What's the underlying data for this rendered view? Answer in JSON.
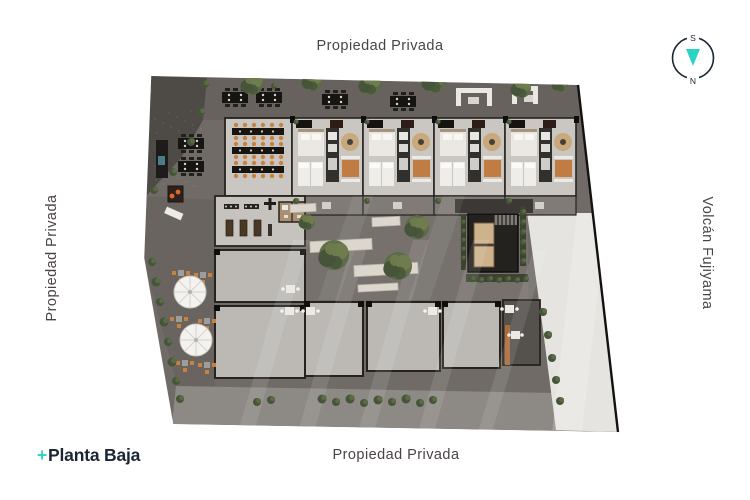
{
  "labels": {
    "top": "Propiedad Privada",
    "bottom": "Propiedad Privada",
    "left": "Propiedad Privada",
    "right": "Volcán Fujiyama"
  },
  "logo": {
    "prefix": "+",
    "text": "Planta Baja"
  },
  "compass": {
    "top_letter": "S",
    "bottom_letter": "N"
  },
  "colors": {
    "label": "#4b4444",
    "navy": "#1b2533",
    "teal": "#2bd4c2",
    "line_black": "#131210",
    "paving": "#706b67",
    "paving_dark": "#5e5a56",
    "gravel": "#4e4b47",
    "floor": "#cac7c3",
    "floor_dim": "#bcb9b5",
    "terrace": "#807b77",
    "wall": "#26231f",
    "black": "#161512",
    "cream": "#ebe8e3",
    "tan": "#c9a87c",
    "orange": "#c07c42",
    "rust": "#ad6a35",
    "chair": "#c8823f",
    "green": "#5d6b45",
    "green_dark": "#46553a",
    "green_light": "#6e7c4e",
    "ramp": "#e6e4e0",
    "sidewalk": "#8d8985",
    "bench": "#dcd6cc",
    "core": "#24221f",
    "kitchen": "#31302d",
    "bath": "#a98f6f"
  },
  "plan": {
    "outline": "150,76 578,85 618,432 172,424 143,258",
    "gravel": "150,76 207,78 203,120 181,158 146,196 144,150 147,100",
    "left_strip": "146,196 215,200 215,392 178,388 143,258",
    "sidewalk": "176,386 611,394 618,432 172,424",
    "ramp": "527,213 593,213 618,432 556,430 543,330",
    "courtyard": [
      302,
      216,
      226,
      84
    ],
    "unit_xs": [
      292,
      363,
      434,
      505
    ],
    "dining": [
      225,
      118,
      67,
      78
    ],
    "gym": [
      215,
      196,
      90,
      50
    ],
    "bath": [
      279,
      202,
      26,
      20
    ],
    "rooms": [
      [
        215,
        250,
        90,
        52
      ],
      [
        215,
        306,
        90,
        72
      ],
      [
        305,
        302,
        58,
        74
      ],
      [
        367,
        302,
        73,
        69
      ],
      [
        443,
        302,
        57,
        66
      ]
    ],
    "right_section": [
      503,
      300,
      37,
      65
    ],
    "core": [
      468,
      214,
      50,
      58
    ],
    "connector": [
      455,
      199,
      78,
      14
    ],
    "trees": [
      [
        252,
        84,
        11
      ],
      [
        312,
        81,
        10
      ],
      [
        370,
        84,
        11
      ],
      [
        434,
        81,
        12
      ],
      [
        521,
        88,
        10
      ],
      [
        560,
        84,
        8
      ],
      [
        334,
        255,
        15
      ],
      [
        398,
        266,
        14
      ],
      [
        417,
        227,
        12
      ],
      [
        307,
        222,
        8
      ]
    ],
    "bushes": [
      [
        152,
        262,
        4
      ],
      [
        156,
        282,
        4.5
      ],
      [
        160,
        302,
        4
      ],
      [
        164,
        322,
        4.5
      ],
      [
        168,
        342,
        4
      ],
      [
        172,
        362,
        4.5
      ],
      [
        176,
        381,
        4
      ],
      [
        180,
        399,
        4
      ],
      [
        205,
        84,
        4
      ],
      [
        201,
        112,
        4
      ],
      [
        191,
        142,
        4
      ],
      [
        173,
        172,
        4
      ],
      [
        154,
        190,
        4
      ],
      [
        148,
        92,
        3.5
      ],
      [
        257,
        402,
        4
      ],
      [
        271,
        400,
        4
      ],
      [
        322,
        399,
        4.5
      ],
      [
        336,
        402,
        4
      ],
      [
        350,
        399,
        4.5
      ],
      [
        364,
        403,
        4
      ],
      [
        378,
        400,
        4.5
      ],
      [
        392,
        402,
        4
      ],
      [
        406,
        399,
        4.5
      ],
      [
        420,
        403,
        4
      ],
      [
        433,
        400,
        4
      ],
      [
        543,
        312,
        4
      ],
      [
        548,
        335,
        4
      ],
      [
        552,
        358,
        4
      ],
      [
        556,
        380,
        4
      ],
      [
        560,
        401,
        4
      ],
      [
        463,
        222,
        2.5
      ],
      [
        463,
        231,
        2.5
      ],
      [
        463,
        240,
        2.5
      ],
      [
        463,
        249,
        2.5
      ],
      [
        463,
        258,
        2.5
      ],
      [
        523,
        212,
        3
      ],
      [
        523,
        222,
        3
      ],
      [
        523,
        232,
        3
      ],
      [
        523,
        242,
        3
      ],
      [
        523,
        252,
        3
      ],
      [
        523,
        261,
        3
      ],
      [
        472,
        279,
        3
      ],
      [
        481,
        280,
        3
      ],
      [
        490,
        279,
        3
      ],
      [
        499,
        280,
        3
      ],
      [
        508,
        279,
        3
      ],
      [
        517,
        280,
        3
      ],
      [
        526,
        279,
        3
      ],
      [
        296,
        201,
        3
      ],
      [
        367,
        201,
        3
      ],
      [
        438,
        201,
        3
      ],
      [
        509,
        201,
        3
      ],
      [
        296,
        122,
        2.5
      ],
      [
        367,
        122,
        2.5
      ],
      [
        438,
        122,
        2.5
      ],
      [
        509,
        122,
        2.5
      ],
      [
        274,
        86,
        3
      ]
    ],
    "benches": [
      [
        310,
        240,
        62,
        11,
        -3
      ],
      [
        354,
        264,
        64,
        11,
        -3
      ],
      [
        358,
        284,
        40,
        7,
        -3
      ],
      [
        372,
        217,
        28,
        9,
        -3
      ],
      [
        290,
        204,
        26,
        8,
        -3
      ]
    ],
    "black_tables": [
      [
        222,
        92
      ],
      [
        256,
        92
      ],
      [
        322,
        94
      ],
      [
        390,
        96
      ],
      [
        178,
        138
      ],
      [
        178,
        161
      ]
    ],
    "cafe_tables": [
      [
        178,
        270
      ],
      [
        200,
        272
      ],
      [
        176,
        316
      ],
      [
        204,
        318
      ],
      [
        182,
        360
      ],
      [
        204,
        362
      ]
    ],
    "terrace_tables": [
      [
        306,
        307
      ],
      [
        428,
        307
      ],
      [
        505,
        305
      ],
      [
        286,
        285
      ],
      [
        285,
        307
      ]
    ],
    "umbrellas": [
      [
        190,
        292,
        16
      ],
      [
        196,
        340,
        16
      ]
    ],
    "streaks": [
      [
        238,
        240,
        432,
        16,
        55,
        0.1
      ],
      [
        298,
        240,
        432,
        16,
        55,
        0.1
      ],
      [
        358,
        240,
        432,
        16,
        55,
        0.1
      ],
      [
        418,
        240,
        432,
        16,
        55,
        0.1
      ],
      [
        478,
        250,
        432,
        14,
        55,
        0.1
      ],
      [
        318,
        196,
        300,
        20,
        35,
        0.07
      ],
      [
        408,
        196,
        300,
        22,
        35,
        0.07
      ],
      [
        552,
        213,
        432,
        30,
        25,
        0.18
      ]
    ],
    "sofas": [
      [
        456,
        88,
        36
      ],
      [
        512,
        86,
        26
      ]
    ],
    "bar": [
      156,
      140,
      12,
      38
    ],
    "grill": [
      168,
      186,
      15,
      16
    ],
    "sunbed": [
      165,
      210,
      18,
      7
    ]
  }
}
